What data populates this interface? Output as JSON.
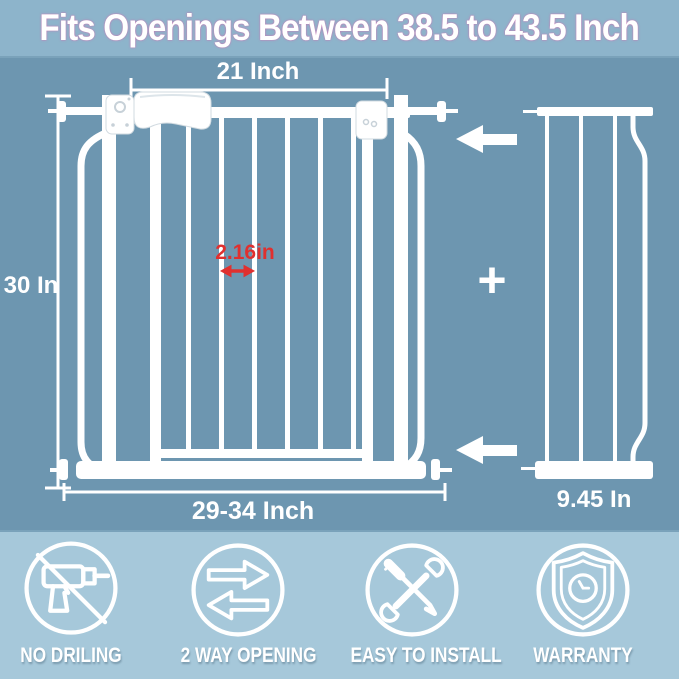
{
  "colors": {
    "bg-header": "#8db4cb",
    "bg-main": "#6d96b0",
    "bg-footer": "#a6c8da",
    "gate-white": "#ffffff",
    "accent-red": "#e0302f"
  },
  "header": {
    "title": "Fits Openings Between 38.5 to 43.5 Inch"
  },
  "diagram": {
    "top_width": "21 Inch",
    "height": "30 In",
    "bar_gap": "2.16in",
    "bottom_width_range": "29-34 Inch",
    "extension_width": "9.45 In",
    "plus_sign": "+"
  },
  "features": [
    {
      "icon": "no-drill-icon",
      "label": "NO DRILING"
    },
    {
      "icon": "two-way-opening-icon",
      "label": "2 WAY OPENING"
    },
    {
      "icon": "crossed-tools-icon",
      "label": "EASY TO INSTALL"
    },
    {
      "icon": "shield-warranty-icon",
      "label": "WARRANTY"
    }
  ]
}
